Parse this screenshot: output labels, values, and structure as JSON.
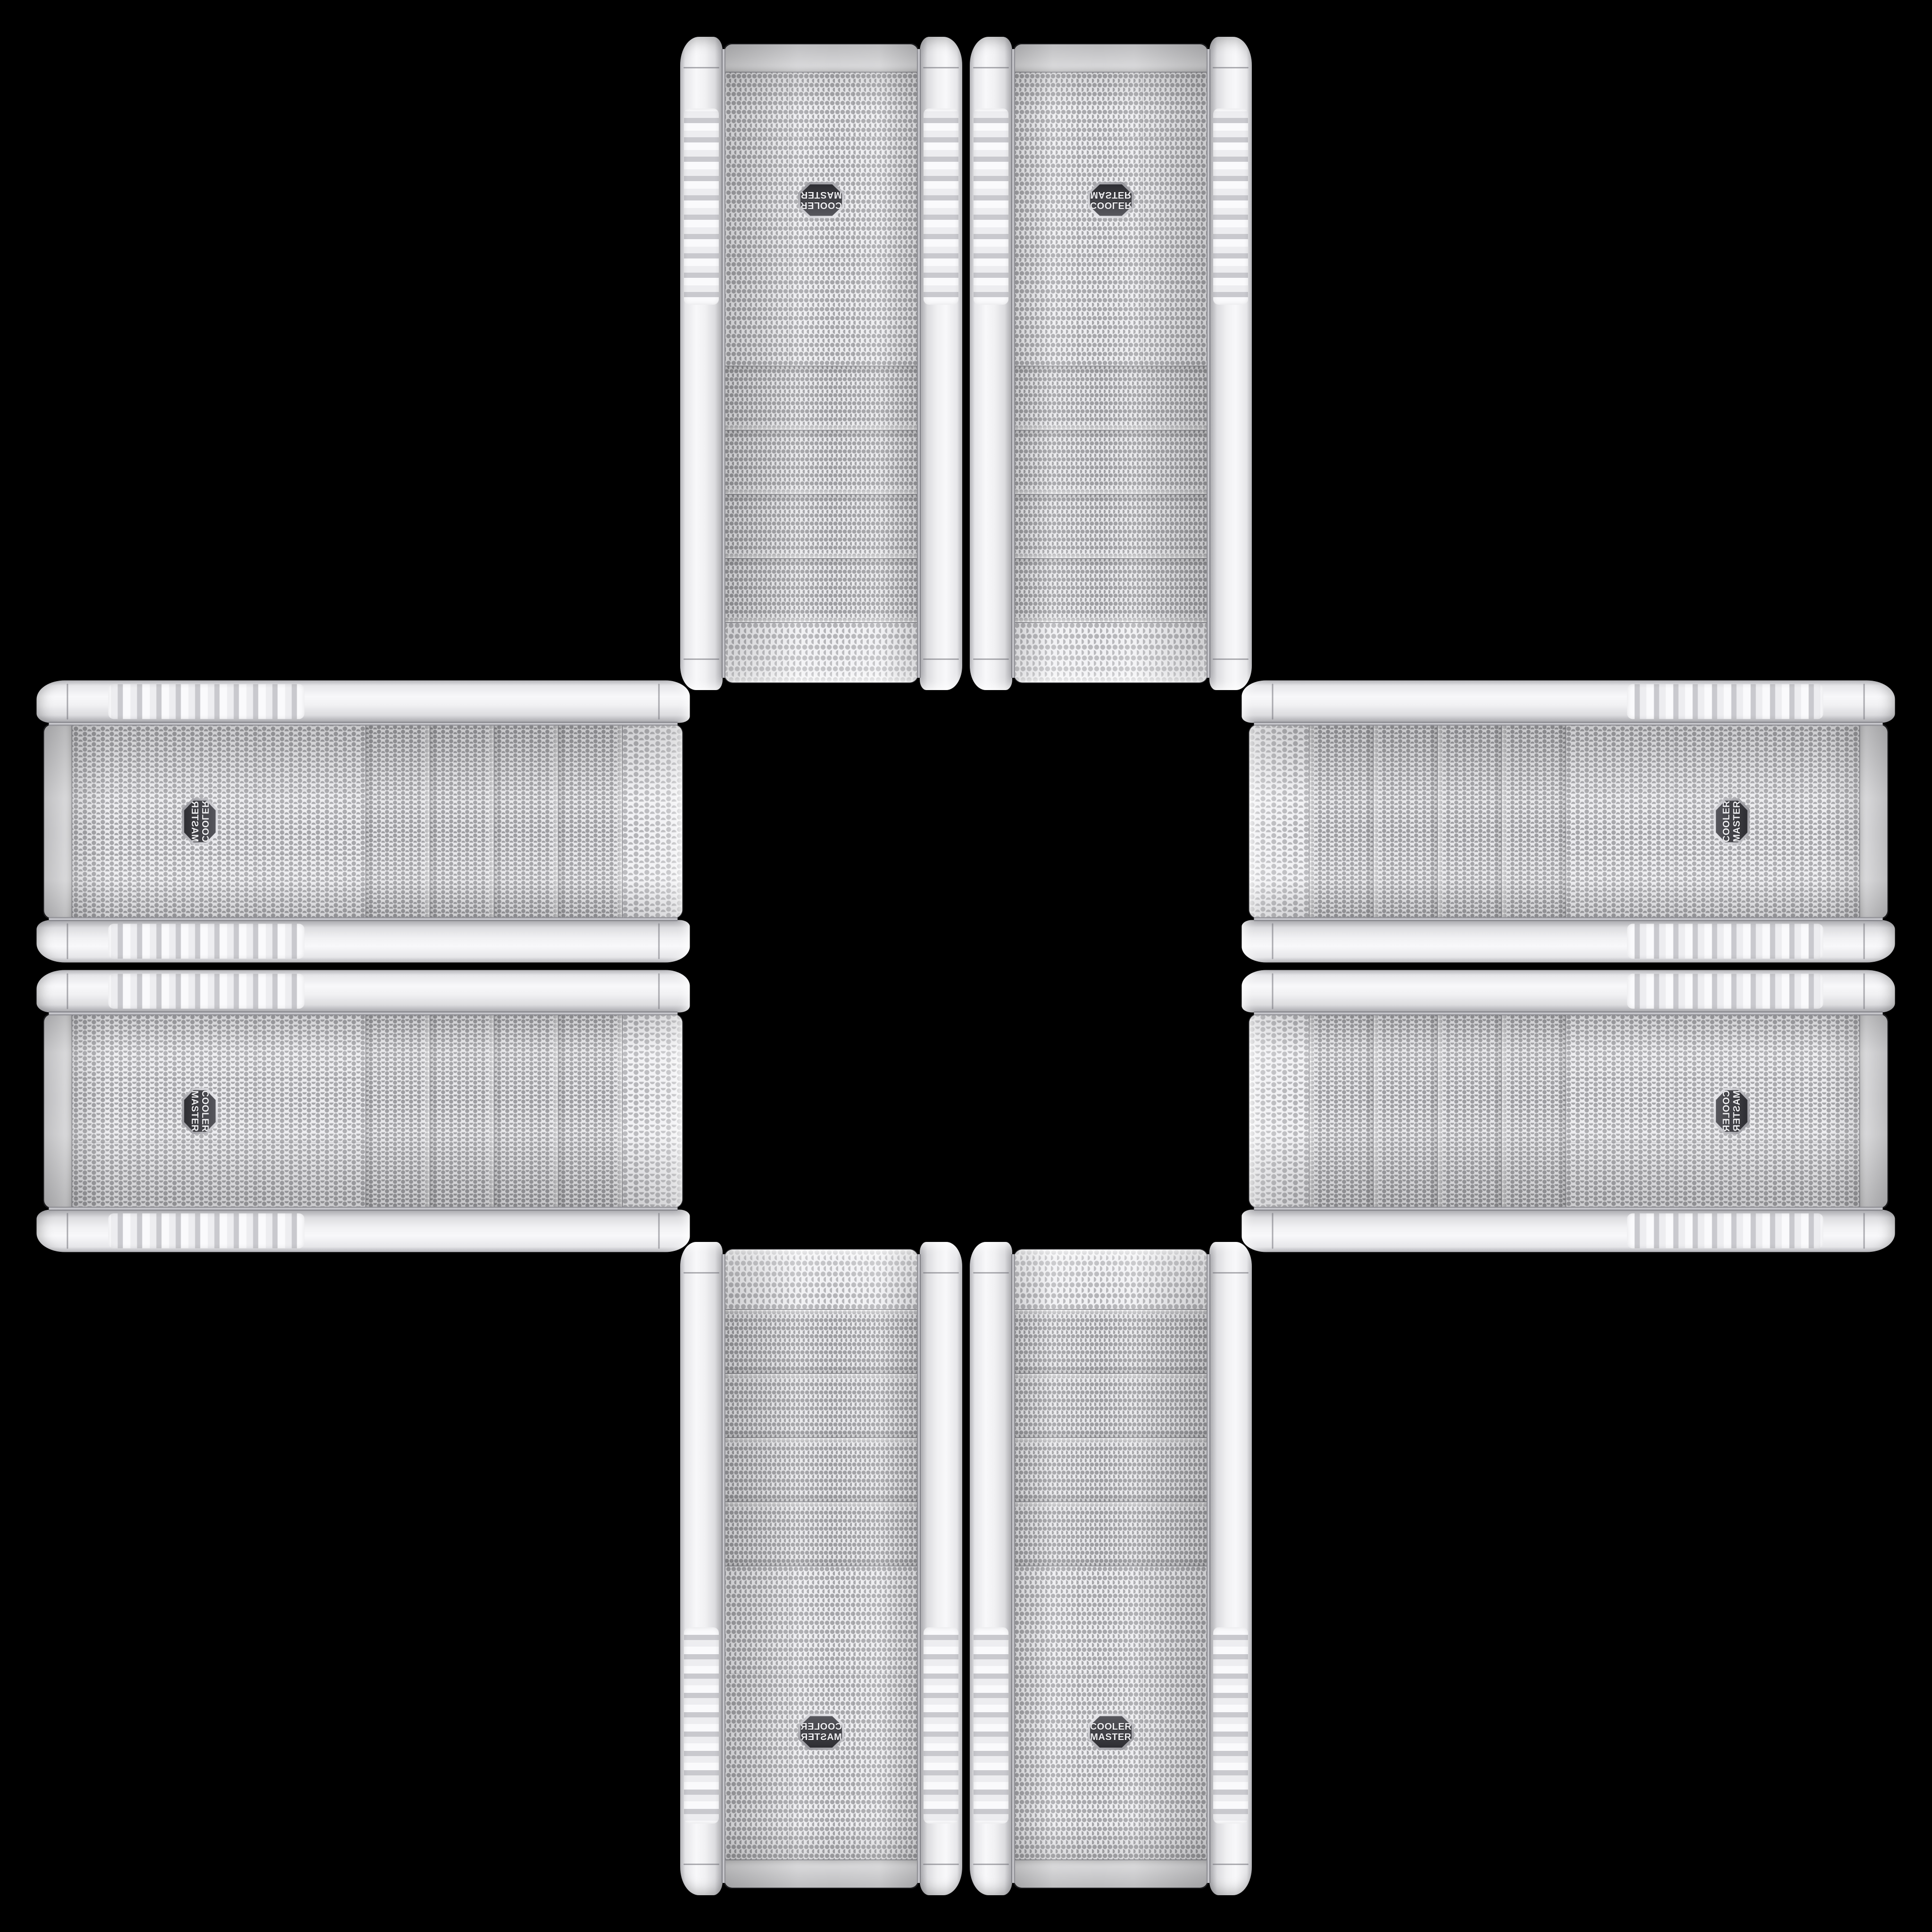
{
  "scene": {
    "background_color": "#000000"
  },
  "badge": {
    "line1": "COOLER",
    "line2": "MASTER"
  },
  "colors": {
    "case_body": "#f2f2f4",
    "rail_shadow": "#a5a5aa",
    "mesh_background": "#ececef",
    "mesh_dot": "#a4a4a8",
    "bay_dot": "#9b9b9f",
    "chrome_trim": "#d8d8dd",
    "badge_background": "#3a3a40",
    "badge_border": "#cfcfd4",
    "badge_text": "#efeff2"
  },
  "cases": [
    {
      "position": "top-left"
    },
    {
      "position": "top-right"
    },
    {
      "position": "left-top"
    },
    {
      "position": "left-bottom"
    },
    {
      "position": "right-top"
    },
    {
      "position": "right-bottom"
    },
    {
      "position": "bottom-left"
    },
    {
      "position": "bottom-right"
    }
  ]
}
